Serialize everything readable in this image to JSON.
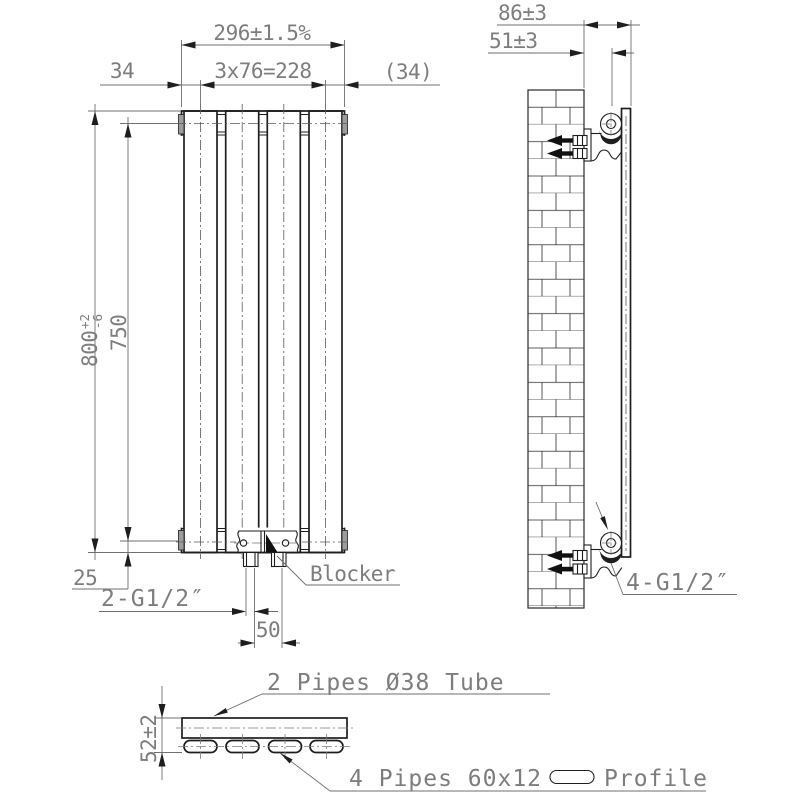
{
  "front_view": {
    "dim_width": "296±1.5%",
    "dim_spacing": "3x76=228",
    "dim_edge_left": "34",
    "dim_edge_right": "(34)",
    "dim_height": "800",
    "dim_height_tol_upper": "+2",
    "dim_height_tol_lower": "-6",
    "dim_pipe_span": "750",
    "dim_bottom_offset": "25",
    "dim_pipe_distance": "50",
    "label_connection": "2-G1/2″",
    "label_blocker": "Blocker"
  },
  "side_view": {
    "dim_depth": "86±3",
    "dim_pipe_center": "51±3",
    "label_connection": "4-G1/2″"
  },
  "section_view": {
    "dim_thickness": "52±2",
    "label_top_pipes": "2 Pipes Ø38 Tube",
    "label_bottom_pipes": "4 Pipes 60x12",
    "label_profile": "Profile"
  },
  "colors": {
    "object_line": "#1e1e1e",
    "dimension_line": "#6f6f6f",
    "dimension_text": "#7d7d7d",
    "end_cap_fill": "#9c9c9c",
    "background": "#ffffff"
  }
}
